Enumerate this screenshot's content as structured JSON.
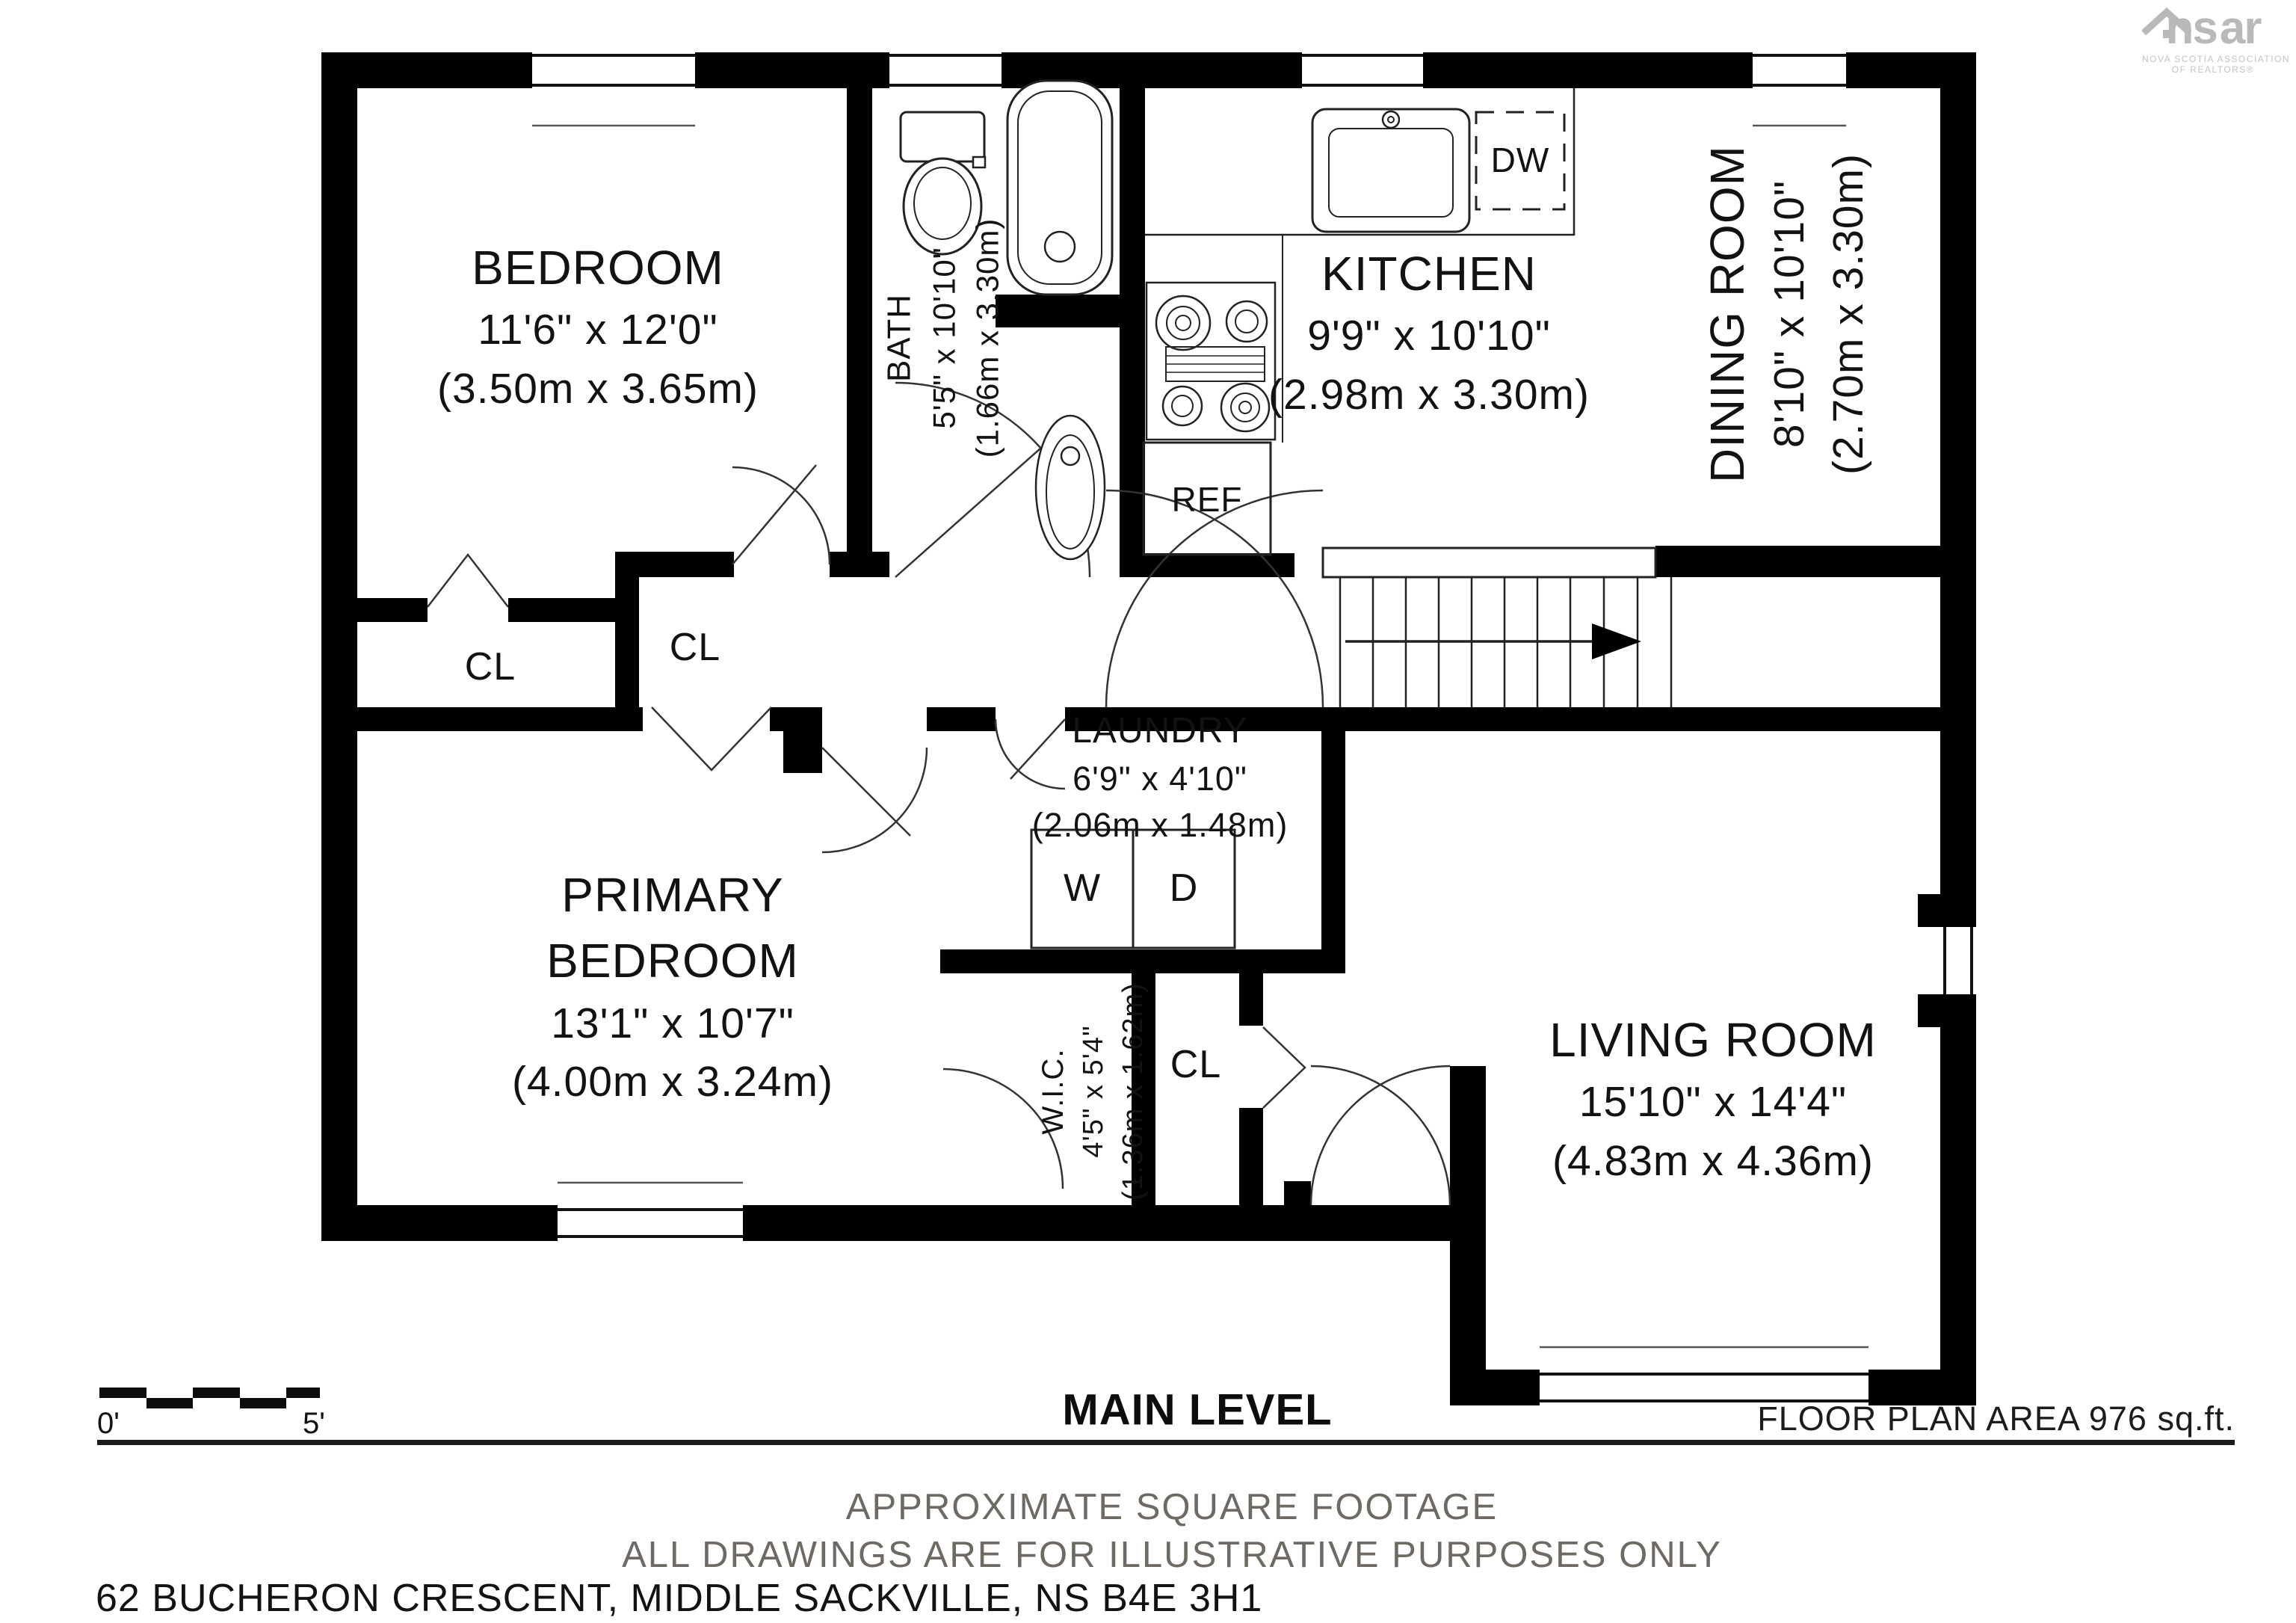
{
  "title": {
    "floor": "MAIN LEVEL",
    "area": "FLOOR PLAN AREA 976 sq.ft."
  },
  "footer": {
    "line1": "APPROXIMATE SQUARE FOOTAGE",
    "line2": "ALL DRAWINGS ARE FOR ILLUSTRATIVE PURPOSES ONLY",
    "address": "62 BUCHERON CRESCENT, MIDDLE SACKVILLE, NS B4E 3H1"
  },
  "logo": {
    "left": "ns",
    "right": "ar",
    "sub1": "NOVA SCOTIA ASSOCIATION",
    "sub2": "OF REALTORS®"
  },
  "scale_bar": {
    "start": "0'",
    "end": "5'"
  },
  "rooms": [
    {
      "id": "bedroom",
      "name": "BEDROOM",
      "imperial": "11'6\" x 12'0\"",
      "metric": "(3.50m x 3.65m)"
    },
    {
      "id": "bath",
      "name": "BATH",
      "imperial": "5'5\" x 10'10\"",
      "metric": "(1.66m x 3.30m)"
    },
    {
      "id": "kitchen",
      "name": "KITCHEN",
      "imperial": "9'9\" x 10'10\"",
      "metric": "(2.98m x 3.30m)"
    },
    {
      "id": "dining-room",
      "name": "DINING ROOM",
      "imperial": "8'10\" x 10'10\"",
      "metric": "(2.70m x 3.30m)"
    },
    {
      "id": "laundry",
      "name": "LAUNDRY",
      "imperial": "6'9\" x 4'10\"",
      "metric": "(2.06m x 1.48m)"
    },
    {
      "id": "primary-bedroom",
      "name": "PRIMARY BEDROOM",
      "imperial": "13'1\" x 10'7\"",
      "metric": "(4.00m x 3.24m)"
    },
    {
      "id": "wic",
      "name": "W.I.C.",
      "imperial": "4'5\" x 5'4\"",
      "metric": "(1.36m x 1.62m)"
    },
    {
      "id": "living-room",
      "name": "LIVING ROOM",
      "imperial": "15'10\" x 14'4\"",
      "metric": "(4.83m x 4.36m)"
    }
  ],
  "labels": {
    "closet": "CL",
    "washer": "W",
    "dryer": "D",
    "dishwasher": "DW",
    "refrigerator": "REF"
  },
  "colors": {
    "wall": "#000000",
    "text": "#121212",
    "muted": "#6e6963",
    "logo_gray": "#b9b9b9",
    "line": "#1a1a1a"
  }
}
